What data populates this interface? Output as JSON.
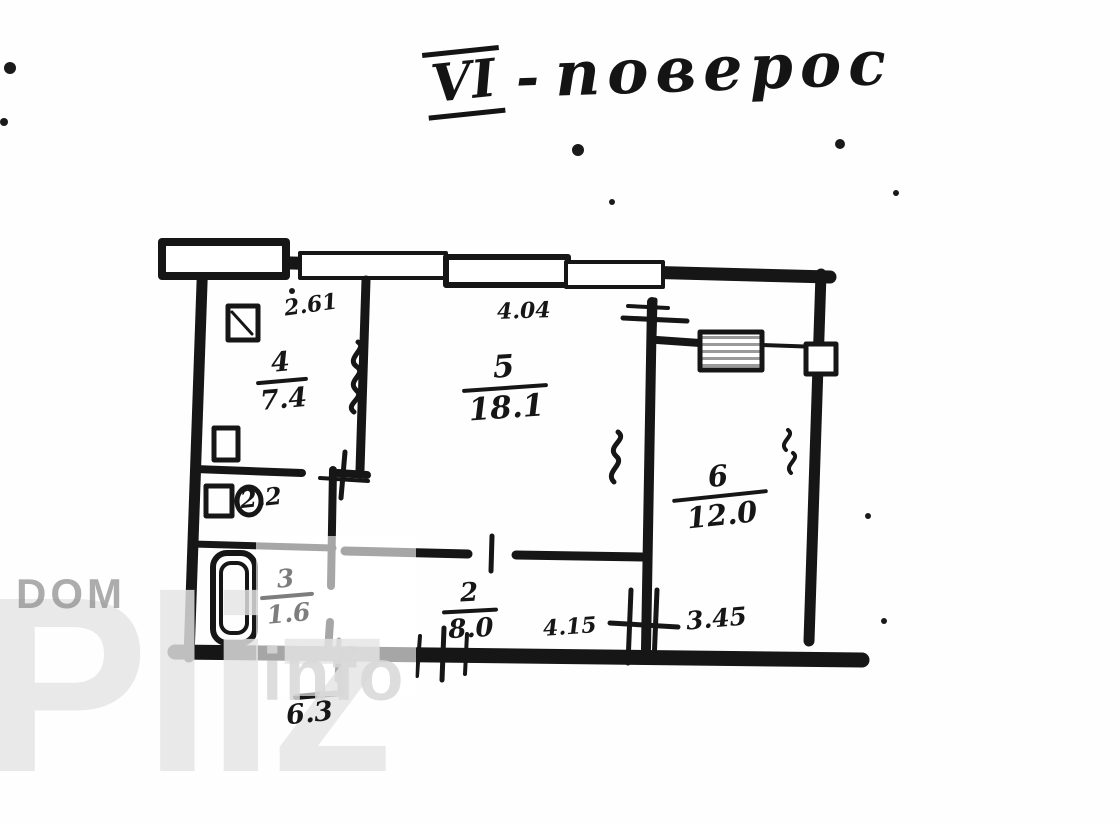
{
  "title": {
    "numeral": "VI",
    "dash": "-",
    "word": "поверос"
  },
  "watermark": {
    "dom": "DOM",
    "pliz": "Pliz",
    "info": "info"
  },
  "rooms": {
    "kitchen": {
      "number": "4",
      "area": "7.4"
    },
    "living": {
      "number": "5",
      "area": "18.1"
    },
    "bedroom": {
      "number": "6",
      "area": "12.0"
    },
    "bathroom": {
      "number": "3",
      "area": "1.6"
    },
    "wc": {
      "area": "2.2"
    },
    "hallway": {
      "number": "2",
      "area": "8.0"
    }
  },
  "dimensions": {
    "kitchen_top": "2.61",
    "living_top": "4.04",
    "hallway_bottom": "4.15",
    "bedroom_bottom": "3.45",
    "entry_bottom": "6.3"
  },
  "colors": {
    "ink": "#161616",
    "watermark_gray": "#b2b2b2"
  }
}
